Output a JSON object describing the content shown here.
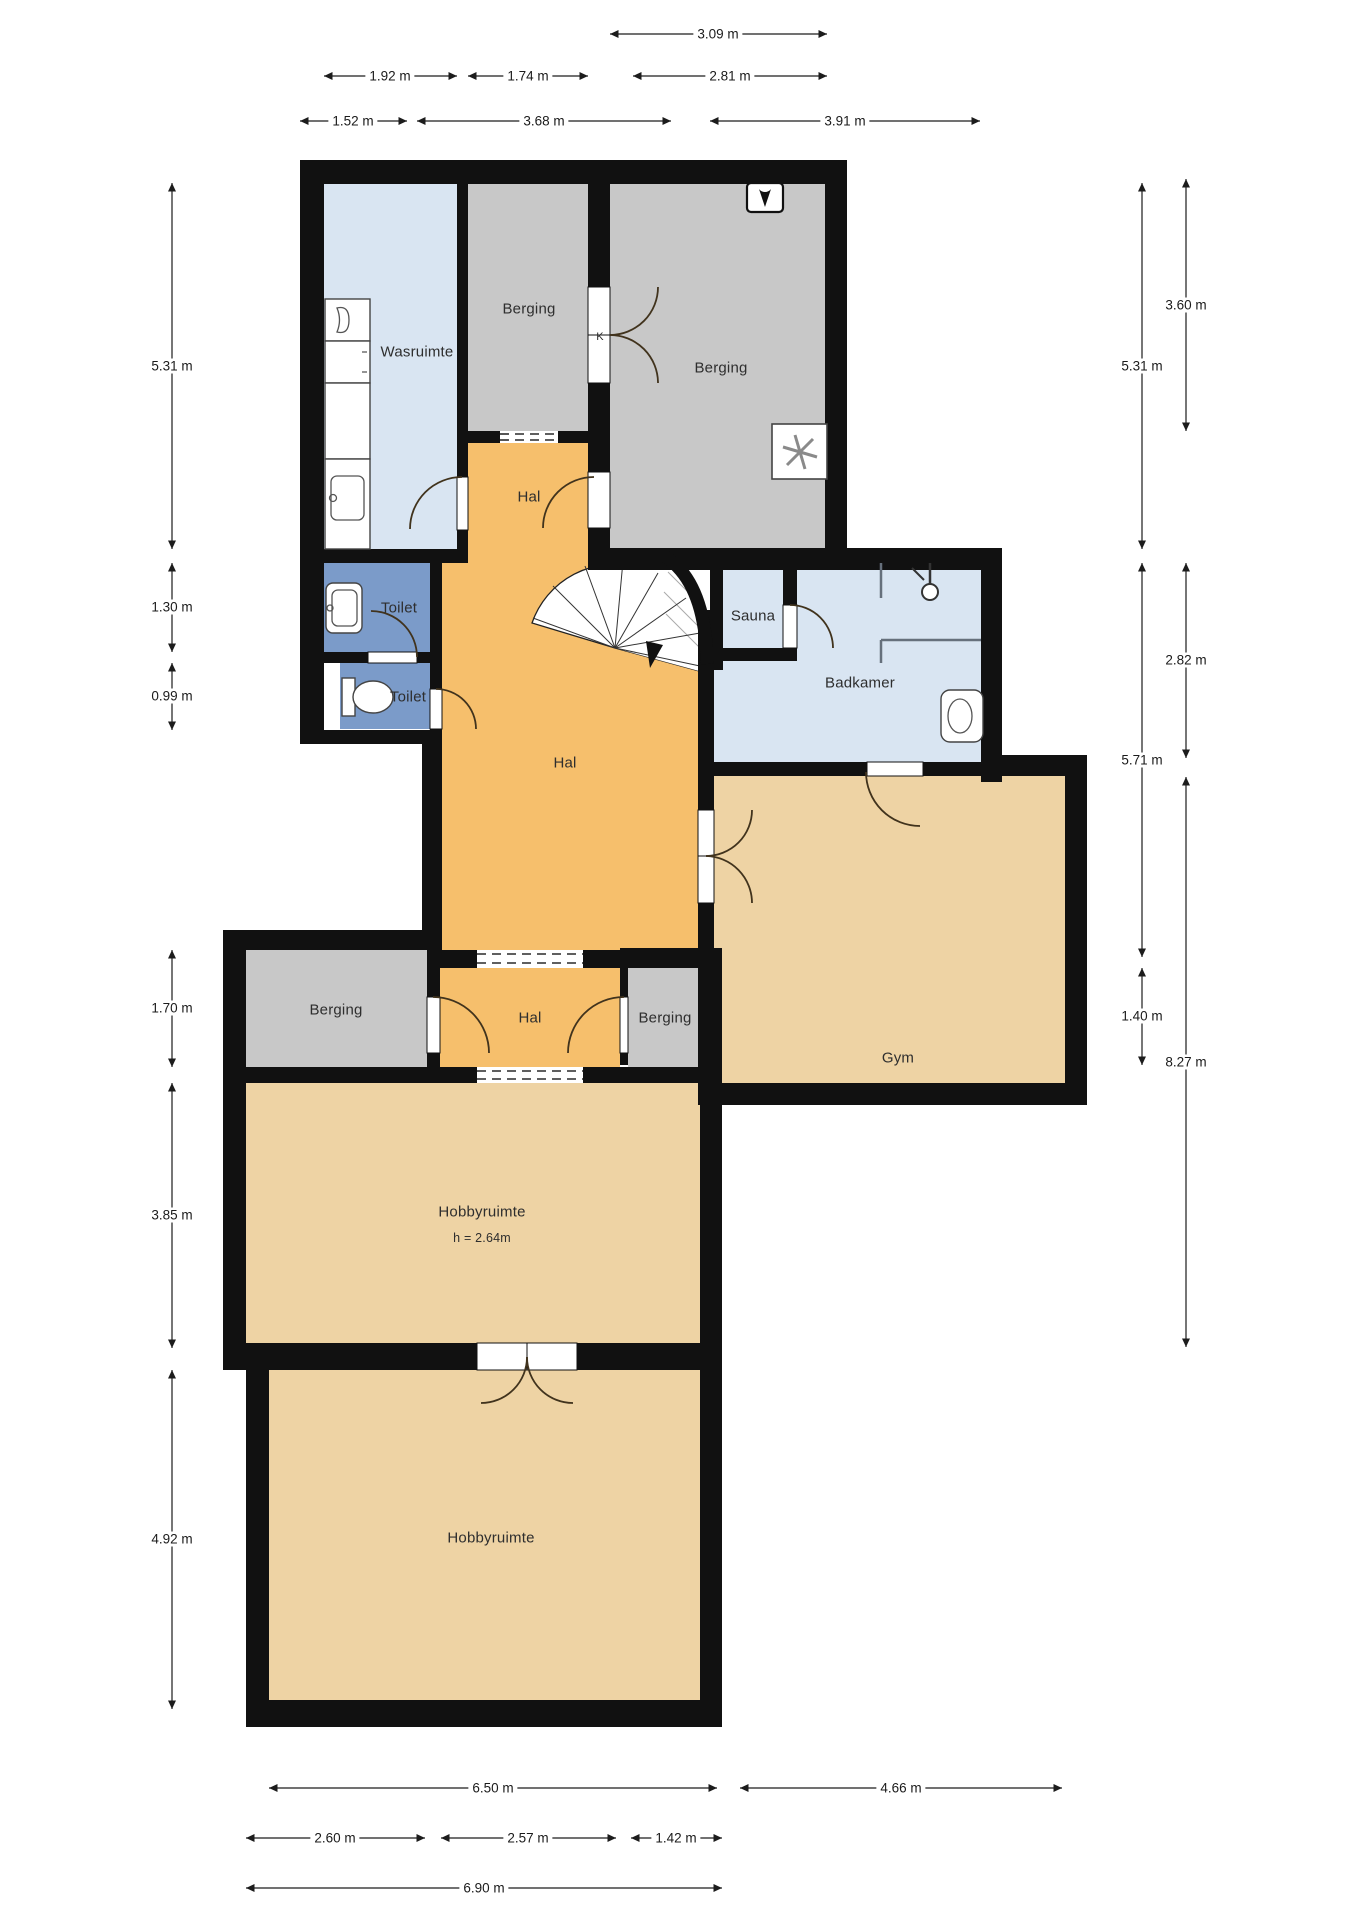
{
  "plan": {
    "type": "floor-plan",
    "floor": "basement / souterrain",
    "rooms": {
      "wasruimte": {
        "label": "Wasruimte"
      },
      "berging_north_mid": {
        "label": "Berging"
      },
      "berging_north_right": {
        "label": "Berging"
      },
      "hal_upper": {
        "label": "Hal"
      },
      "toilet_upper": {
        "label": "Toilet"
      },
      "toilet_lower": {
        "label": "Toilet"
      },
      "sauna": {
        "label": "Sauna"
      },
      "badkamer": {
        "label": "Badkamer"
      },
      "hal_main": {
        "label": "Hal"
      },
      "berging_west": {
        "label": "Berging"
      },
      "hal_small": {
        "label": "Hal"
      },
      "berging_mid_lower": {
        "label": "Berging"
      },
      "gym": {
        "label": "Gym"
      },
      "hobbyruimte": {
        "label": "Hobbyruimte",
        "ceiling_height": "h = 2.64m"
      },
      "hobbyruimte_south": {
        "label": "Hobbyruimte"
      },
      "closet": {
        "label": "K"
      }
    },
    "dimensions": {
      "top": [
        [
          "3.09 m"
        ],
        [
          "1.92 m",
          "1.74 m",
          "2.81 m"
        ],
        [
          "1.52 m",
          "3.68 m",
          "3.91 m"
        ]
      ],
      "left": [
        "5.31 m",
        "1.30 m",
        "0.99 m",
        "1.70 m",
        "3.85 m",
        "4.92 m"
      ],
      "right_inner": [
        "5.31 m",
        "5.71 m",
        "1.40 m"
      ],
      "right_outer": [
        "3.60 m",
        "2.82 m",
        "8.27 m"
      ],
      "bottom": [
        [
          "6.50 m",
          "4.66 m"
        ],
        [
          "2.60 m",
          "2.57 m",
          "1.42 m"
        ],
        [
          "6.90 m"
        ]
      ]
    },
    "colors": {
      "wall": "#111111",
      "hal_orange": "#f6bf6c",
      "storage_gray": "#c8c8c8",
      "wet_room_blue": "#d9e5f2",
      "toilet_blue": "#7b9bc9",
      "living_tan": "#eed3a4",
      "background": "#ffffff"
    },
    "icons": [
      "washing-machine-icon",
      "sink-icon",
      "toilet-icon",
      "shower-icon",
      "bathroom-sink-icon",
      "mechanical-ventilation-icon",
      "meter-icon",
      "spiral-staircase-icon",
      "door-swing-icon",
      "double-door-icon",
      "open-passage-dashed-icon"
    ]
  }
}
